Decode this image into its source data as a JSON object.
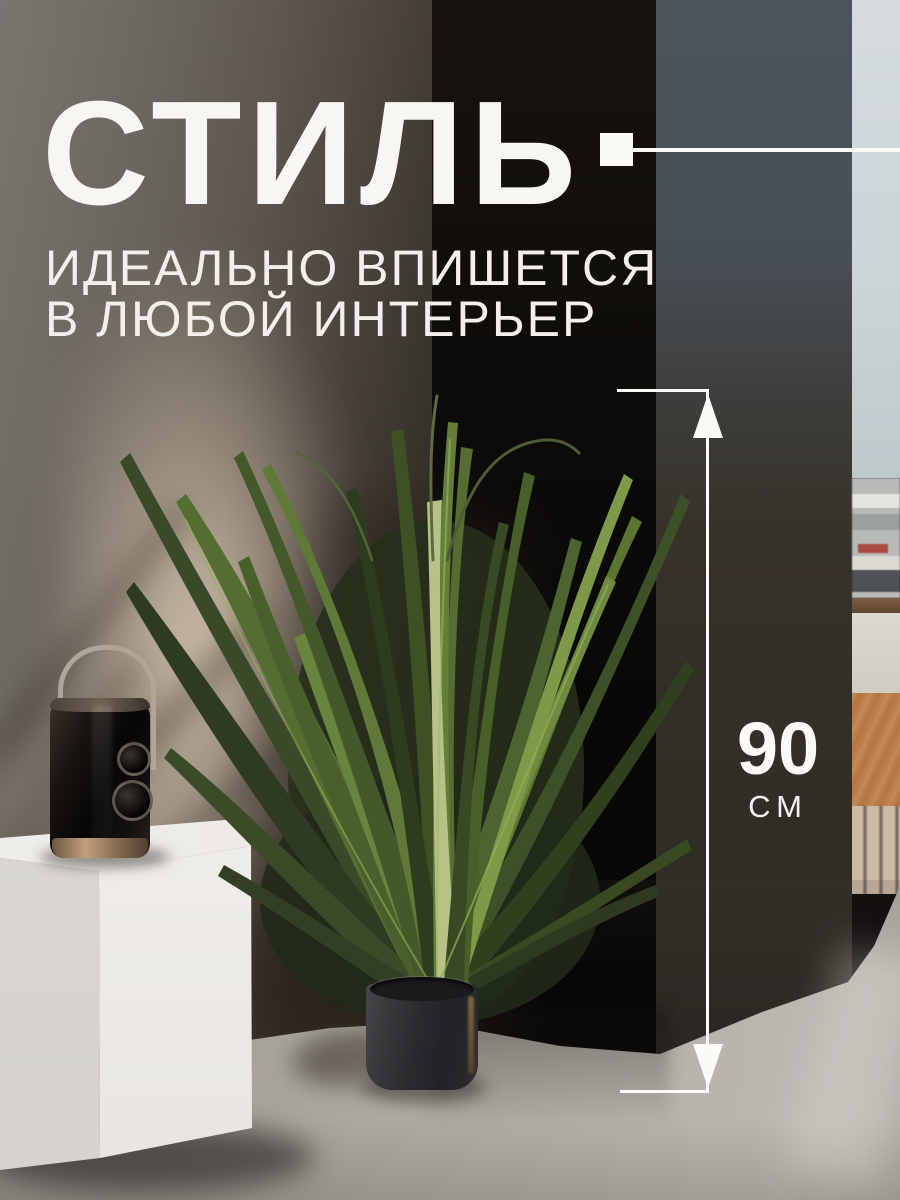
{
  "meta": {
    "kind": "marketplace-product-infographic",
    "language": "ru",
    "scene": "artificial grass plant in black pot, white pedestal with speaker, dark pillars, window city view"
  },
  "headline": {
    "title": "СТИЛЬ",
    "subtitle_line1": "ИДЕАЛЬНО ВПИШЕТСЯ",
    "subtitle_line2": "В ЛЮБОЙ ИНТЕРЬЕР"
  },
  "dimension": {
    "value": "90",
    "unit": "СМ"
  },
  "colors": {
    "overlay_white": "#fbfaf7",
    "text_white": "#f6f4f0",
    "pillar_black": "#0d0b0a",
    "pillar_right_top": "#4d545e",
    "pillar_right_bottom": "#2a2520",
    "wall_beige": "#8a8076",
    "wall_light": "#c9b9a5",
    "floor_gray": "#aaa59e",
    "sky": "#d3d9dd",
    "roof_orange": "#bc7c4e",
    "plant_green_dark": "#2e3b21",
    "plant_green_bright": "#6e8b41",
    "pot_charcoal": "#26262a",
    "cube_white": "#f2f0ec"
  }
}
